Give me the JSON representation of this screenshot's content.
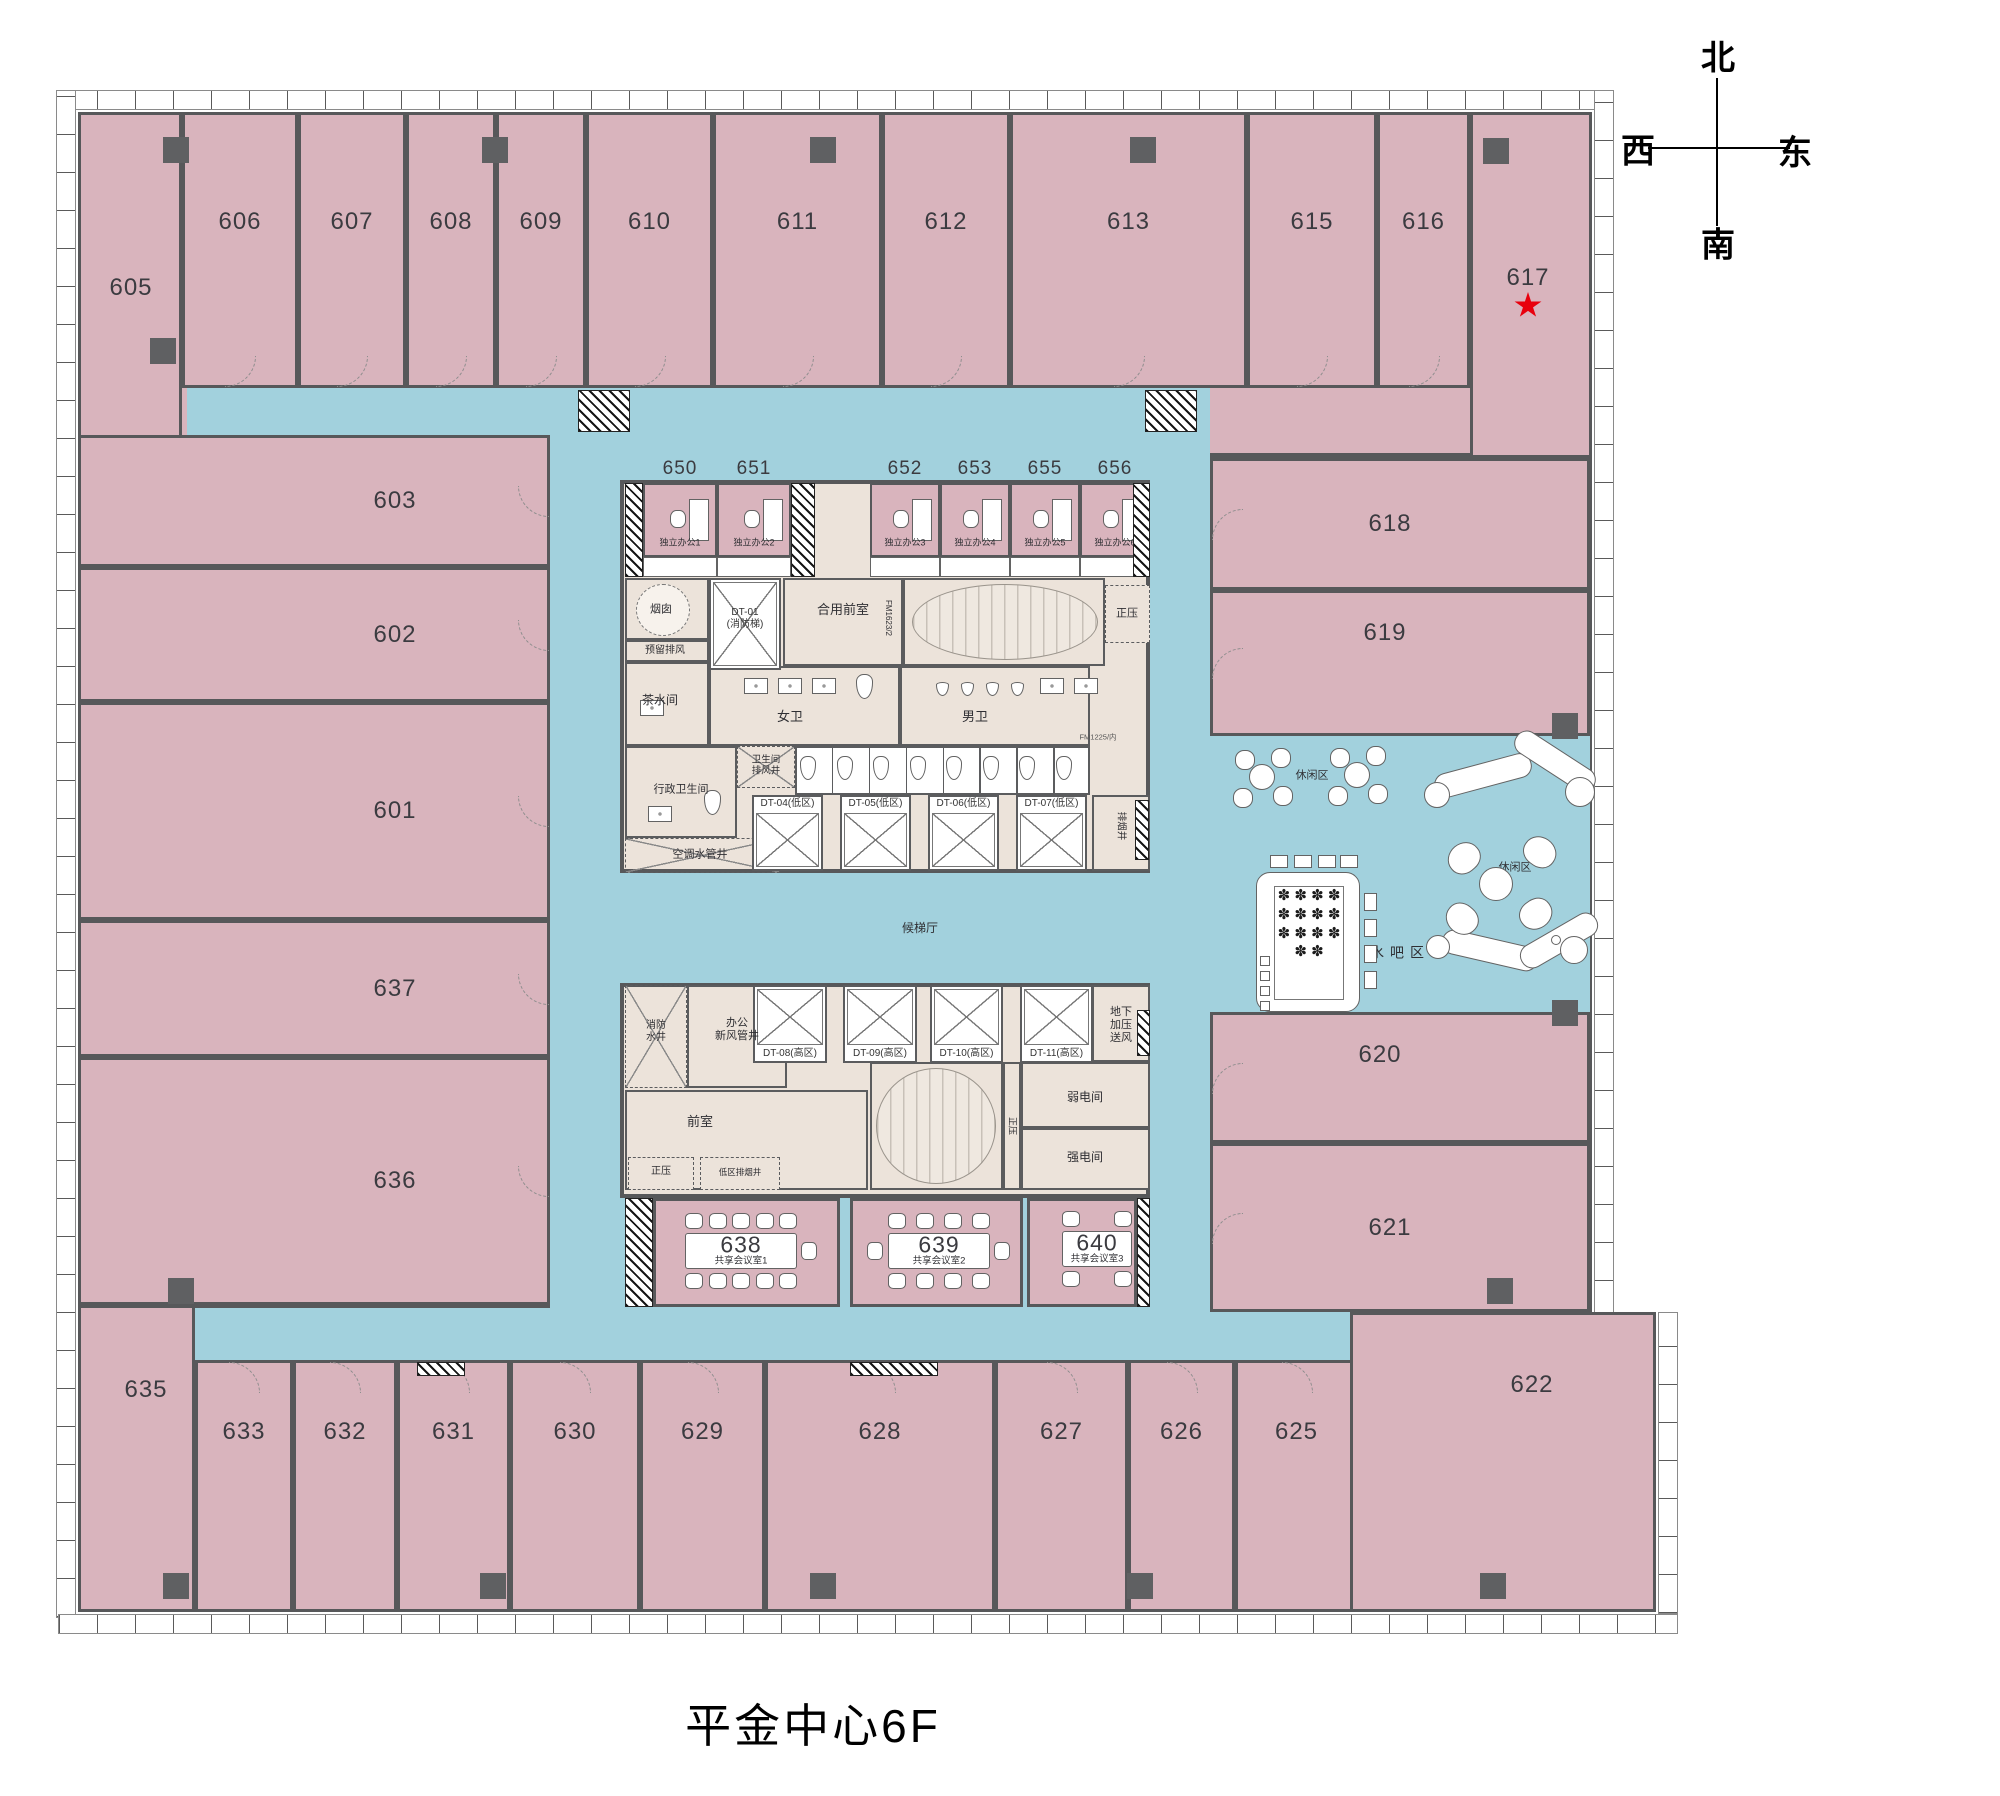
{
  "title": "平金中心6F",
  "compass": {
    "north": "北",
    "south": "南",
    "west": "西",
    "east": "东"
  },
  "colors": {
    "room": "#d9b4bd",
    "corridor": "#a2d1dd",
    "corebg": "#ece3da",
    "wall": "#57585a",
    "star": "#e8000d"
  },
  "starred_room": "617",
  "plan": {
    "rooms": [
      {
        "id": "605",
        "x": 78,
        "y": 112,
        "w": 104,
        "h": 327,
        "lx": 131,
        "ly": 288
      },
      {
        "id": "606",
        "x": 182,
        "y": 112,
        "w": 116,
        "h": 276,
        "ly": 222,
        "door": "bottom"
      },
      {
        "id": "607",
        "x": 298,
        "y": 112,
        "w": 108,
        "h": 276,
        "ly": 222,
        "door": "bottom"
      },
      {
        "id": "608",
        "x": 406,
        "y": 112,
        "w": 90,
        "h": 276,
        "ly": 222,
        "door": "bottom"
      },
      {
        "id": "609",
        "x": 496,
        "y": 112,
        "w": 90,
        "h": 276,
        "ly": 222,
        "door": "bottom"
      },
      {
        "id": "610",
        "x": 586,
        "y": 112,
        "w": 127,
        "h": 276,
        "ly": 222,
        "door": "bottom"
      },
      {
        "id": "611",
        "x": 713,
        "y": 112,
        "w": 169,
        "h": 276,
        "ly": 222,
        "door": "bottom"
      },
      {
        "id": "612",
        "x": 882,
        "y": 112,
        "w": 128,
        "h": 276,
        "ly": 222,
        "door": "bottom"
      },
      {
        "id": "613",
        "x": 1010,
        "y": 112,
        "w": 237,
        "h": 276,
        "ly": 222,
        "door": "bottom"
      },
      {
        "id": "615",
        "x": 1247,
        "y": 112,
        "w": 130,
        "h": 276,
        "ly": 222,
        "door": "bottom"
      },
      {
        "id": "616",
        "x": 1377,
        "y": 112,
        "w": 93,
        "h": 276,
        "ly": 222,
        "door": "bottom"
      },
      {
        "id": "617",
        "x": 1470,
        "y": 112,
        "w": 122,
        "h": 346,
        "lx": 1528,
        "ly": 278,
        "star": true
      },
      {
        "id": "603",
        "x": 78,
        "y": 435,
        "w": 472,
        "h": 132,
        "lx": 395,
        "door": "right"
      },
      {
        "id": "602",
        "x": 78,
        "y": 567,
        "w": 472,
        "h": 135,
        "lx": 395,
        "door": "right"
      },
      {
        "id": "601",
        "x": 78,
        "y": 702,
        "w": 472,
        "h": 218,
        "lx": 395,
        "door": "right"
      },
      {
        "id": "637",
        "x": 78,
        "y": 920,
        "w": 472,
        "h": 137,
        "lx": 395,
        "door": "right"
      },
      {
        "id": "636",
        "x": 78,
        "y": 1057,
        "w": 472,
        "h": 248,
        "lx": 395,
        "door": "right"
      },
      {
        "id": "635",
        "x": 78,
        "y": 1305,
        "w": 117,
        "h": 307,
        "lx": 146,
        "ly": 1390
      },
      {
        "id": "633",
        "x": 195,
        "y": 1360,
        "w": 98,
        "h": 252,
        "ly": 1432,
        "door": "top"
      },
      {
        "id": "632",
        "x": 293,
        "y": 1360,
        "w": 104,
        "h": 252,
        "ly": 1432,
        "door": "top"
      },
      {
        "id": "631",
        "x": 397,
        "y": 1360,
        "w": 113,
        "h": 252,
        "ly": 1432,
        "door": "top"
      },
      {
        "id": "630",
        "x": 510,
        "y": 1360,
        "w": 130,
        "h": 252,
        "ly": 1432,
        "door": "top"
      },
      {
        "id": "629",
        "x": 640,
        "y": 1360,
        "w": 125,
        "h": 252,
        "ly": 1432,
        "door": "top"
      },
      {
        "id": "628",
        "x": 765,
        "y": 1360,
        "w": 230,
        "h": 252,
        "ly": 1432,
        "door": "top"
      },
      {
        "id": "627",
        "x": 995,
        "y": 1360,
        "w": 133,
        "h": 252,
        "ly": 1432,
        "door": "top"
      },
      {
        "id": "626",
        "x": 1128,
        "y": 1360,
        "w": 107,
        "h": 252,
        "ly": 1432,
        "door": "top"
      },
      {
        "id": "625",
        "x": 1235,
        "y": 1360,
        "w": 123,
        "h": 252,
        "ly": 1432,
        "door": "top"
      },
      {
        "id": "623",
        "x": 1358,
        "y": 1360,
        "w": 122,
        "h": 252,
        "ly": 1432,
        "door": "top"
      },
      {
        "id": "618",
        "x": 1210,
        "y": 458,
        "w": 380,
        "h": 132,
        "lx": 1390,
        "door": "left"
      },
      {
        "id": "619",
        "x": 1210,
        "y": 590,
        "w": 380,
        "h": 146,
        "lx": 1385,
        "ly": 633,
        "door": "left"
      },
      {
        "id": "620",
        "x": 1210,
        "y": 1012,
        "w": 380,
        "h": 131,
        "lx": 1380,
        "ly": 1055,
        "door": "left"
      },
      {
        "id": "621",
        "x": 1210,
        "y": 1143,
        "w": 380,
        "h": 169,
        "lx": 1390,
        "door": "left"
      },
      {
        "id": "622",
        "x": 1350,
        "y": 1312,
        "w": 306,
        "h": 300,
        "lx": 1532,
        "ly": 1385
      }
    ],
    "mini_offices": [
      {
        "num": "650",
        "label": "独立办公1",
        "x": 643,
        "w": 74
      },
      {
        "num": "651",
        "label": "独立办公2",
        "x": 717,
        "w": 74
      },
      {
        "num": "652",
        "label": "独立办公3",
        "x": 870,
        "w": 70
      },
      {
        "num": "653",
        "label": "独立办公4",
        "x": 940,
        "w": 70
      },
      {
        "num": "655",
        "label": "独立办公5",
        "x": 1010,
        "w": 70
      },
      {
        "num": "656",
        "label": "独立办公6",
        "x": 1080,
        "w": 70
      }
    ],
    "elevators": [
      {
        "label": "DT-01\n(消防梯)",
        "x": 709,
        "y": 578,
        "w": 72,
        "h": 92,
        "lpos": "center"
      },
      {
        "label": "DT-04(低区)",
        "x": 752,
        "y": 795,
        "w": 71,
        "h": 76,
        "lpos": "top"
      },
      {
        "label": "DT-05(低区)",
        "x": 840,
        "y": 795,
        "w": 71,
        "h": 76,
        "lpos": "top"
      },
      {
        "label": "DT-06(低区)",
        "x": 928,
        "y": 795,
        "w": 71,
        "h": 76,
        "lpos": "top"
      },
      {
        "label": "DT-07(低区)",
        "x": 1016,
        "y": 795,
        "w": 71,
        "h": 76,
        "lpos": "top"
      },
      {
        "label": "DT-08(高区)",
        "x": 753,
        "y": 985,
        "w": 74,
        "h": 78,
        "lpos": "bottom"
      },
      {
        "label": "DT-09(高区)",
        "x": 843,
        "y": 985,
        "w": 74,
        "h": 78,
        "lpos": "bottom"
      },
      {
        "label": "DT-10(高区)",
        "x": 930,
        "y": 985,
        "w": 73,
        "h": 78,
        "lpos": "bottom"
      },
      {
        "label": "DT-11(高区)",
        "x": 1020,
        "y": 985,
        "w": 73,
        "h": 78,
        "lpos": "bottom"
      }
    ],
    "cells": [
      {
        "x": 625,
        "y": 578,
        "w": 84,
        "h": 62
      },
      {
        "x": 625,
        "y": 640,
        "w": 84,
        "h": 22
      },
      {
        "x": 625,
        "y": 662,
        "w": 84,
        "h": 84
      },
      {
        "x": 783,
        "y": 578,
        "w": 120,
        "h": 88
      },
      {
        "x": 903,
        "y": 578,
        "w": 202,
        "h": 88
      },
      {
        "x": 1105,
        "y": 585,
        "w": 45,
        "h": 58,
        "dash": true
      },
      {
        "x": 709,
        "y": 666,
        "w": 191,
        "h": 80
      },
      {
        "x": 900,
        "y": 666,
        "w": 190,
        "h": 80
      },
      {
        "x": 625,
        "y": 746,
        "w": 112,
        "h": 92
      },
      {
        "x": 737,
        "y": 746,
        "w": 58,
        "h": 42,
        "dash": true,
        "x2": true
      },
      {
        "x": 795,
        "y": 746,
        "w": 295,
        "h": 49,
        "white": true
      },
      {
        "x": 625,
        "y": 838,
        "w": 155,
        "h": 35,
        "dash": true,
        "x2": true
      },
      {
        "x": 1092,
        "y": 795,
        "w": 58,
        "h": 76
      },
      {
        "x": 625,
        "y": 985,
        "w": 62,
        "h": 103,
        "dash": true,
        "x2": true
      },
      {
        "x": 687,
        "y": 985,
        "w": 100,
        "h": 103
      },
      {
        "x": 1092,
        "y": 985,
        "w": 58,
        "h": 77
      },
      {
        "x": 625,
        "y": 1090,
        "w": 243,
        "h": 100
      },
      {
        "x": 628,
        "y": 1157,
        "w": 66,
        "h": 33,
        "dash": true
      },
      {
        "x": 700,
        "y": 1157,
        "w": 80,
        "h": 33,
        "dash": true
      },
      {
        "x": 870,
        "y": 1062,
        "w": 133,
        "h": 128
      },
      {
        "x": 1003,
        "y": 1062,
        "w": 18,
        "h": 128
      },
      {
        "x": 1021,
        "y": 1062,
        "w": 129,
        "h": 66
      },
      {
        "x": 1021,
        "y": 1128,
        "w": 129,
        "h": 62
      }
    ],
    "labels": [
      {
        "t": "烟囱",
        "x": 661,
        "y": 610,
        "fs": 11
      },
      {
        "t": "预留排风",
        "x": 665,
        "y": 651,
        "fs": 10
      },
      {
        "t": "茶水间",
        "x": 660,
        "y": 700,
        "fs": 12
      },
      {
        "t": "合用前室",
        "x": 843,
        "y": 610,
        "fs": 13
      },
      {
        "t": "FM1623/2",
        "x": 888,
        "y": 618,
        "fs": 8,
        "rot": 90
      },
      {
        "t": "正压",
        "x": 1127,
        "y": 614,
        "fs": 11
      },
      {
        "t": "女卫",
        "x": 790,
        "y": 717,
        "fs": 13
      },
      {
        "t": "男卫",
        "x": 975,
        "y": 717,
        "fs": 13
      },
      {
        "t": "FM1225/内",
        "x": 1098,
        "y": 737,
        "fs": 7.5,
        "col": "#555"
      },
      {
        "t": "卫生间\n排风井",
        "x": 766,
        "y": 766,
        "fs": 9.5
      },
      {
        "t": "行政卫生间",
        "x": 681,
        "y": 790,
        "fs": 11
      },
      {
        "t": "空调水管井",
        "x": 700,
        "y": 855,
        "fs": 11
      },
      {
        "t": "排烟井",
        "x": 1121,
        "y": 826,
        "fs": 9.5,
        "rot": 90
      },
      {
        "t": "候梯厅",
        "x": 920,
        "y": 928,
        "fs": 12
      },
      {
        "t": "消防\n水井",
        "x": 656,
        "y": 1032,
        "fs": 10
      },
      {
        "t": "办公\n新风管井",
        "x": 737,
        "y": 1030,
        "fs": 11
      },
      {
        "t": "地下\n加压\n送风",
        "x": 1121,
        "y": 1026,
        "fs": 11
      },
      {
        "t": "前室",
        "x": 700,
        "y": 1122,
        "fs": 13
      },
      {
        "t": "正压",
        "x": 661,
        "y": 1172,
        "fs": 10
      },
      {
        "t": "低区排烟井",
        "x": 740,
        "y": 1172,
        "fs": 8.5
      },
      {
        "t": "正压",
        "x": 1012,
        "y": 1126,
        "fs": 9,
        "rot": 90
      },
      {
        "t": "弱电间",
        "x": 1085,
        "y": 1097,
        "fs": 12
      },
      {
        "t": "强电间",
        "x": 1085,
        "y": 1157,
        "fs": 12
      },
      {
        "t": "休闲区",
        "x": 1312,
        "y": 776,
        "fs": 11
      },
      {
        "t": "休闲区",
        "x": 1515,
        "y": 868,
        "fs": 11
      },
      {
        "t": "水吧区",
        "x": 1400,
        "y": 953,
        "fs": 14,
        "ls": 6
      },
      {
        "t": "定制花艺装置",
        "x": 1307,
        "y": 948,
        "fs": 8,
        "col": "#666"
      }
    ],
    "meeting_rooms": [
      {
        "num": "638",
        "label": "共享会议室1",
        "x": 653,
        "y": 1198,
        "w": 187,
        "h": 109,
        "table": {
          "x": 685,
          "y": 1233,
          "w": 112,
          "h": 36
        },
        "chairs": {
          "top": 5,
          "bottom": 5,
          "left": 0,
          "right": 1
        }
      },
      {
        "num": "639",
        "label": "共享会议室2",
        "x": 850,
        "y": 1198,
        "w": 173,
        "h": 109,
        "table": {
          "x": 888,
          "y": 1233,
          "w": 102,
          "h": 36
        },
        "chairs": {
          "top": 4,
          "bottom": 4,
          "left": 1,
          "right": 1
        }
      },
      {
        "num": "640",
        "label": "共享会议室3",
        "x": 1027,
        "y": 1198,
        "w": 110,
        "h": 109,
        "table": {
          "x": 1062,
          "y": 1231,
          "w": 70,
          "h": 36
        },
        "chairs": {
          "top": 2,
          "bottom": 2,
          "left": 0,
          "right": 0
        }
      }
    ],
    "stairs": [
      {
        "x": 912,
        "y": 584,
        "w": 186,
        "h": 76
      },
      {
        "x": 876,
        "y": 1068,
        "w": 120,
        "h": 116
      }
    ],
    "hatches": [
      {
        "x": 625,
        "y": 483,
        "w": 18,
        "h": 94
      },
      {
        "x": 791,
        "y": 483,
        "w": 24,
        "h": 94
      },
      {
        "x": 1133,
        "y": 483,
        "w": 17,
        "h": 94
      },
      {
        "x": 625,
        "y": 1198,
        "w": 28,
        "h": 109
      },
      {
        "x": 1137,
        "y": 1198,
        "w": 13,
        "h": 109
      },
      {
        "x": 578,
        "y": 390,
        "w": 52,
        "h": 42
      },
      {
        "x": 1145,
        "y": 390,
        "w": 52,
        "h": 42
      },
      {
        "x": 850,
        "y": 1362,
        "w": 88,
        "h": 14
      },
      {
        "x": 417,
        "y": 1362,
        "w": 48,
        "h": 14
      },
      {
        "x": 1135,
        "y": 800,
        "w": 14,
        "h": 60
      },
      {
        "x": 1137,
        "y": 1010,
        "w": 13,
        "h": 46
      }
    ],
    "columns": [
      {
        "x": 163,
        "y": 137
      },
      {
        "x": 482,
        "y": 137
      },
      {
        "x": 810,
        "y": 137
      },
      {
        "x": 1130,
        "y": 137
      },
      {
        "x": 1483,
        "y": 138
      },
      {
        "x": 150,
        "y": 338
      },
      {
        "x": 168,
        "y": 1278
      },
      {
        "x": 1487,
        "y": 1278
      },
      {
        "x": 163,
        "y": 1573
      },
      {
        "x": 480,
        "y": 1573
      },
      {
        "x": 810,
        "y": 1573
      },
      {
        "x": 1127,
        "y": 1573
      },
      {
        "x": 1480,
        "y": 1573
      },
      {
        "x": 1552,
        "y": 713
      },
      {
        "x": 1552,
        "y": 1000
      }
    ],
    "round_tables": [
      {
        "x": 1262,
        "y": 777
      },
      {
        "x": 1357,
        "y": 775
      }
    ],
    "sofas": [
      {
        "x": 1433,
        "y": 763,
        "w": 100,
        "h": 25,
        "rot": -15
      },
      {
        "x": 1509,
        "y": 749,
        "w": 92,
        "h": 25,
        "rot": 33
      },
      {
        "x": 1441,
        "y": 938,
        "w": 98,
        "h": 25,
        "rot": 13
      },
      {
        "x": 1516,
        "y": 928,
        "w": 86,
        "h": 25,
        "rot": -30
      }
    ],
    "armchairs": [
      {
        "x": 1447,
        "y": 843,
        "rot": -40
      },
      {
        "x": 1523,
        "y": 837,
        "rot": 35
      },
      {
        "x": 1445,
        "y": 904,
        "rot": 220
      },
      {
        "x": 1519,
        "y": 899,
        "rot": 145
      }
    ],
    "circles": [
      {
        "cx": 1496,
        "cy": 884,
        "r": 17
      },
      {
        "cx": 1437,
        "cy": 795,
        "r": 13
      },
      {
        "cx": 1580,
        "cy": 792,
        "r": 15
      },
      {
        "cx": 1438,
        "cy": 947,
        "r": 12
      },
      {
        "cx": 1574,
        "cy": 950,
        "r": 14
      },
      {
        "cx": 1556,
        "cy": 940,
        "r": 5
      }
    ],
    "waterbar": {
      "table": {
        "x": 1256,
        "y": 872,
        "w": 104,
        "h": 140
      },
      "stools_top": [
        {
          "x": 1270,
          "y": 855
        },
        {
          "x": 1294,
          "y": 855
        },
        {
          "x": 1318,
          "y": 855
        },
        {
          "x": 1340,
          "y": 855
        }
      ],
      "chairs_right": [
        {
          "x": 1364,
          "y": 893
        },
        {
          "x": 1364,
          "y": 919
        },
        {
          "x": 1364,
          "y": 945
        },
        {
          "x": 1364,
          "y": 971
        }
      ],
      "small_left": [
        {
          "x": 1260,
          "y": 956
        },
        {
          "x": 1260,
          "y": 971
        },
        {
          "x": 1260,
          "y": 986
        },
        {
          "x": 1260,
          "y": 1001
        }
      ],
      "flower_glyph": "✽"
    },
    "toilet_row": {
      "x": 800,
      "y": 756,
      "count": 8,
      "gap": 36.5
    },
    "stall_row": {
      "x": 795,
      "y": 746,
      "w": 295,
      "h": 49,
      "count": 8
    },
    "urinals": {
      "x": 936,
      "y": 682,
      "count": 4,
      "gap": 25
    },
    "sinks": [
      {
        "x": 744,
        "y": 678
      },
      {
        "x": 778,
        "y": 678
      },
      {
        "x": 812,
        "y": 678
      },
      {
        "x": 1040,
        "y": 678
      },
      {
        "x": 1074,
        "y": 678
      },
      {
        "x": 640,
        "y": 700
      },
      {
        "x": 648,
        "y": 806
      }
    ],
    "single_toilets": [
      {
        "x": 856,
        "y": 674
      },
      {
        "x": 704,
        "y": 790
      }
    ],
    "star_pos": {
      "x": 1514,
      "y": 292
    }
  }
}
